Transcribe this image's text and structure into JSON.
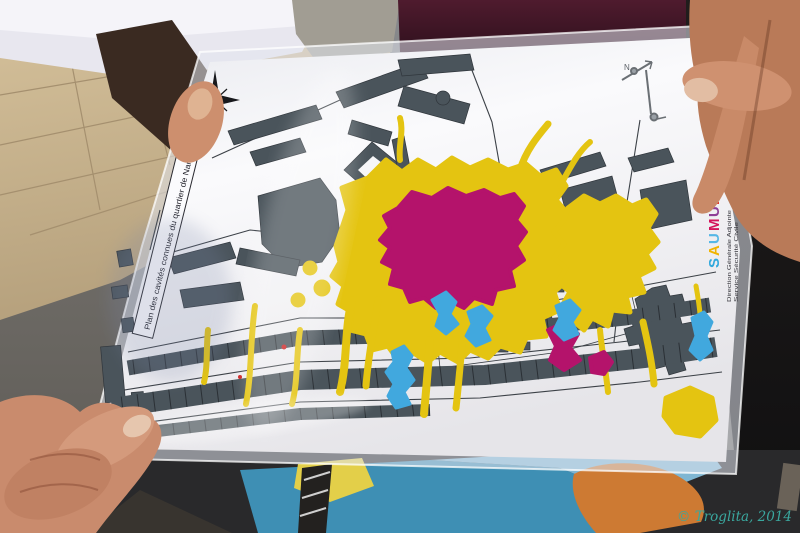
{
  "photo": {
    "watermark": {
      "text": "© Troglita, 2014",
      "color": "#3aa79e"
    }
  },
  "map": {
    "title": "Plan des cavités connues du quartier de Nantilly",
    "north_label": "N",
    "logo": {
      "letters": [
        {
          "ch": "S",
          "color": "#2fa8dd"
        },
        {
          "ch": "A",
          "color": "#f0b400"
        },
        {
          "ch": "U",
          "color": "#56b7e6"
        },
        {
          "ch": "M",
          "color": "#d4145a"
        },
        {
          "ch": "U",
          "color": "#8f3f97"
        },
        {
          "ch": "R",
          "color": "#e6332a"
        }
      ],
      "org_line1": "Direction Générale Adjointe",
      "org_line2": "Service Sécurité Civile"
    },
    "palette": {
      "paper": "#f4f3f6",
      "buildings": "#4a545b",
      "cavities_yellow": "#e4c411",
      "cavities_magenta": "#b4136b",
      "cavities_blue": "#41a8de"
    }
  }
}
